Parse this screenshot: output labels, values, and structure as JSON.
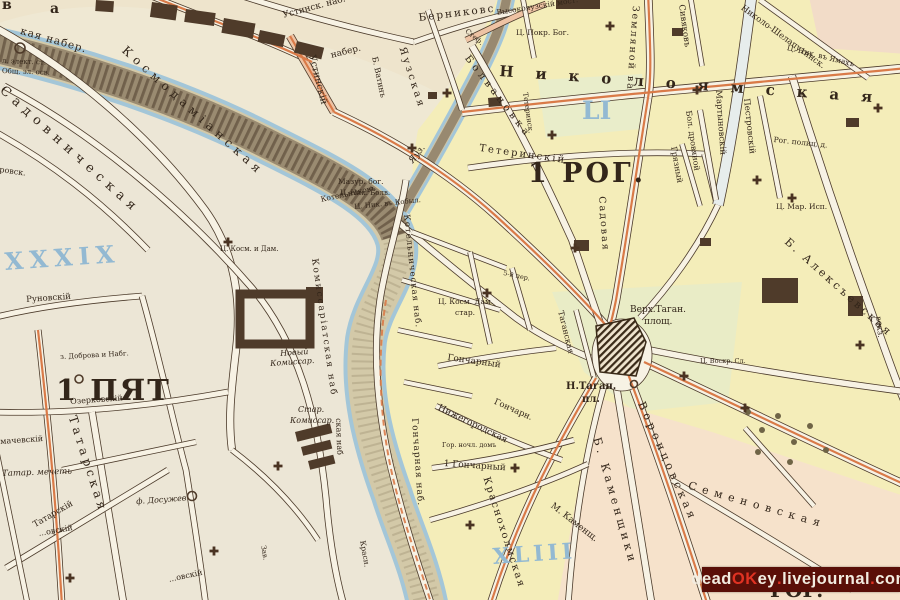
{
  "map": {
    "type": "historic-city-plan",
    "district_labels": [
      "1 ПЯТ",
      "1 РОГ.",
      "РОГ."
    ],
    "district_numerals": [
      "XXXIX",
      "LI",
      "XLIII"
    ],
    "river_labels": [
      "Яуз.",
      "Космодаміанская",
      "кая набер.",
      "Котельническая наб.",
      "Комиссаріатская наб",
      "Гончарная наб.",
      "Устинск. наб."
    ]
  },
  "palette": {
    "paper": "#efe8d3",
    "block_yellow": "#f4edb9",
    "block_cream": "#ece6d6",
    "block_pink": "#f6e2cb",
    "block_green": "#e9ecc6",
    "river_fill": "#d3c9a8",
    "river_edge": "#a3c6d8",
    "road_fill": "#f7f2e4",
    "road_casing": "#4b3a2a",
    "tram_line": "#d97a48",
    "numeral_blue": "#93b9d2",
    "ink": "#33261a",
    "building": "#4f3b2a",
    "watermark_bg": "#5a0f08"
  },
  "symbols": {
    "church_cross_icon": "greek-cross",
    "churches": [
      [
        228,
        242
      ],
      [
        412,
        148
      ],
      [
        447,
        93
      ],
      [
        575,
        248
      ],
      [
        610,
        26
      ],
      [
        697,
        90
      ],
      [
        757,
        180
      ],
      [
        684,
        376
      ],
      [
        278,
        466
      ],
      [
        214,
        551
      ],
      [
        552,
        135
      ],
      [
        487,
        293
      ],
      [
        745,
        408
      ],
      [
        792,
        198
      ],
      [
        515,
        468
      ],
      [
        470,
        525
      ],
      [
        860,
        345
      ],
      [
        878,
        108
      ],
      [
        70,
        578
      ]
    ]
  },
  "labels": [
    {
      "text": "в",
      "x": 2,
      "y": -2,
      "size": 14,
      "w": 600
    },
    {
      "text": "а",
      "x": 50,
      "y": 2,
      "size": 14,
      "w": 600
    },
    {
      "text": "кая набер.",
      "x": 22,
      "y": 26,
      "rot": 16,
      "size": 10.5,
      "sp": 1
    },
    {
      "text": "л. элект. ст.",
      "x": 2,
      "y": 58,
      "rot": 2,
      "size": 7
    },
    {
      "text": "Общ. эл. осв.",
      "x": 2,
      "y": 68,
      "rot": 2,
      "size": 7
    },
    {
      "text": "Садовническая",
      "x": 6,
      "y": 84,
      "rot": 42,
      "size": 13,
      "sp": 6
    },
    {
      "text": "Космодаміанская",
      "x": 128,
      "y": 44,
      "rot": 42,
      "size": 12,
      "sp": 5
    },
    {
      "text": "Устинск. наб.",
      "x": 282,
      "y": 12,
      "rot": -15,
      "size": 9
    },
    {
      "text": "набер.",
      "x": 330,
      "y": 52,
      "rot": -14,
      "size": 9
    },
    {
      "text": "Устинскій",
      "x": 316,
      "y": 54,
      "rot": 76,
      "size": 9.5
    },
    {
      "text": "Берниковс",
      "x": 418,
      "y": 13,
      "rot": -7,
      "size": 10.5,
      "sp": 2
    },
    {
      "text": "Высокояузскій мост.",
      "x": 496,
      "y": 9,
      "rot": -9,
      "size": 7.5
    },
    {
      "text": "Ц. Покр. Бог.",
      "x": 516,
      "y": 29,
      "size": 7.5
    },
    {
      "text": "Стеф.",
      "x": 468,
      "y": 28,
      "rot": 40,
      "size": 7
    },
    {
      "text": "Николоямская",
      "x": 500,
      "y": 64,
      "rot": 4,
      "size": 15,
      "sp": 22,
      "w": 600
    },
    {
      "text": "Земляной ва",
      "x": 640,
      "y": 6,
      "rot": 94,
      "size": 9.5,
      "sp": 2
    },
    {
      "text": "Садовая",
      "x": 606,
      "y": 196,
      "rot": 86,
      "size": 9.5,
      "sp": 2
    },
    {
      "text": "Сивяковъ",
      "x": 685,
      "y": 4,
      "rot": 82,
      "size": 8.5
    },
    {
      "text": "Николо-Шелапутинск.",
      "x": 744,
      "y": 4,
      "rot": 36,
      "size": 8.5
    },
    {
      "text": "Ц. Ник. въ Ямахъ",
      "x": 788,
      "y": 44,
      "rot": 14,
      "size": 7.5
    },
    {
      "text": "Мартыновскій",
      "x": 722,
      "y": 90,
      "rot": 86,
      "size": 8.5
    },
    {
      "text": "Бол. дровяной",
      "x": 692,
      "y": 110,
      "rot": 82,
      "size": 8
    },
    {
      "text": "Грязный",
      "x": 677,
      "y": 146,
      "rot": 80,
      "size": 8
    },
    {
      "text": "Пестровскій",
      "x": 750,
      "y": 98,
      "rot": 84,
      "size": 8.5
    },
    {
      "text": "Рог. полиц. д.",
      "x": 774,
      "y": 136,
      "rot": 6,
      "size": 7.5
    },
    {
      "text": "Ц. Мар. Исп.",
      "x": 776,
      "y": 203,
      "size": 7.5
    },
    {
      "text": "Б. Алексъевская",
      "x": 790,
      "y": 236,
      "rot": 42,
      "size": 11,
      "sp": 3
    },
    {
      "text": "вокз.",
      "x": 882,
      "y": 316,
      "rot": 84,
      "size": 8
    },
    {
      "text": "1 РОГ.",
      "x": 528,
      "y": 160,
      "size": 27,
      "w": 700,
      "sp": 3
    },
    {
      "text": "LI",
      "x": 582,
      "y": 98,
      "size": 25,
      "w": 600,
      "color": "#93b9d2"
    },
    {
      "text": "Тетеринскій",
      "x": 480,
      "y": 144,
      "rot": 8,
      "size": 10,
      "sp": 2
    },
    {
      "text": "Тетеринск.",
      "x": 528,
      "y": 92,
      "rot": 82,
      "size": 7
    },
    {
      "text": "Мазур. бог.",
      "x": 338,
      "y": 178,
      "size": 7.5
    },
    {
      "text": "Ц. Ник. Болв.",
      "x": 340,
      "y": 190,
      "size": 7
    },
    {
      "text": "Б. Ватинъ",
      "x": 378,
      "y": 56,
      "rot": 78,
      "size": 8
    },
    {
      "text": "Яузская",
      "x": 406,
      "y": 46,
      "rot": 72,
      "size": 10,
      "sp": 3
    },
    {
      "text": "Болвановка",
      "x": 470,
      "y": 54,
      "rot": 52,
      "size": 10,
      "sp": 4
    },
    {
      "text": "Котельниковъ",
      "x": 320,
      "y": 196,
      "rot": -12,
      "size": 7.5
    },
    {
      "text": "Яуз.",
      "x": 408,
      "y": 160,
      "rot": -52,
      "size": 9,
      "italic": true
    },
    {
      "text": "Ц. Ник. въ Кобыл.",
      "x": 354,
      "y": 204,
      "rot": -6,
      "size": 7
    },
    {
      "text": "5-й пер.",
      "x": 504,
      "y": 270,
      "rot": 12,
      "size": 6.5
    },
    {
      "text": "Ц. Косм. Дам.",
      "x": 438,
      "y": 298,
      "size": 7.5
    },
    {
      "text": "стар.",
      "x": 455,
      "y": 309,
      "size": 7.5
    },
    {
      "text": "Котельническая наб.",
      "x": 410,
      "y": 214,
      "rot": 84,
      "size": 8.5,
      "sp": 1
    },
    {
      "text": "Комиссаріатская наб",
      "x": 318,
      "y": 258,
      "rot": 82,
      "size": 9,
      "sp": 2
    },
    {
      "text": "Гончарная наб.",
      "x": 418,
      "y": 418,
      "rot": 86,
      "size": 9,
      "sp": 1
    },
    {
      "text": "ская наб",
      "x": 342,
      "y": 418,
      "rot": 88,
      "size": 8
    },
    {
      "text": "Красн.",
      "x": 366,
      "y": 540,
      "rot": 80,
      "size": 7.5
    },
    {
      "text": "Краснохолмская",
      "x": 490,
      "y": 476,
      "rot": 72,
      "size": 10,
      "sp": 2
    },
    {
      "text": "Гончарный",
      "x": 448,
      "y": 354,
      "rot": 8,
      "size": 9
    },
    {
      "text": "Гончарн.",
      "x": 496,
      "y": 398,
      "rot": 24,
      "size": 8.5
    },
    {
      "text": "Нижегородская",
      "x": 440,
      "y": 404,
      "rot": 26,
      "size": 9
    },
    {
      "text": "Гор. ночл. домъ",
      "x": 442,
      "y": 442,
      "size": 6.5
    },
    {
      "text": "1 Гончарный",
      "x": 444,
      "y": 460,
      "rot": 4,
      "size": 9
    },
    {
      "text": "Н.Таган.",
      "x": 566,
      "y": 382,
      "size": 10,
      "w": 600
    },
    {
      "text": "пл.",
      "x": 582,
      "y": 395,
      "size": 10,
      "w": 600
    },
    {
      "text": "Верх.Таган.",
      "x": 630,
      "y": 306,
      "size": 9
    },
    {
      "text": "площ.",
      "x": 644,
      "y": 318,
      "size": 9
    },
    {
      "text": "Таганская",
      "x": 564,
      "y": 310,
      "rot": 76,
      "size": 8
    },
    {
      "text": "Ц. Воскр. Сл.",
      "x": 700,
      "y": 358,
      "size": 6.5
    },
    {
      "text": "М. Каменщ.",
      "x": 554,
      "y": 502,
      "rot": 38,
      "size": 9
    },
    {
      "text": "Б. Каменщики",
      "x": 602,
      "y": 436,
      "rot": 74,
      "size": 11,
      "sp": 4
    },
    {
      "text": "Воронцовская",
      "x": 646,
      "y": 400,
      "rot": 66,
      "size": 11,
      "sp": 4
    },
    {
      "text": "Семеновская",
      "x": 690,
      "y": 480,
      "rot": 16,
      "size": 11,
      "sp": 6
    },
    {
      "text": "РОГ.",
      "x": 770,
      "y": 580,
      "size": 20,
      "w": 700
    },
    {
      "text": "1 ПЯТ",
      "x": 56,
      "y": 376,
      "size": 29,
      "w": 700,
      "sp": 2
    },
    {
      "text": "XXXIX",
      "x": 4,
      "y": 250,
      "rot": -4,
      "size": 24,
      "w": 600,
      "color": "#93b9d2",
      "sp": 6
    },
    {
      "text": "XLIII",
      "x": 492,
      "y": 546,
      "rot": -4,
      "size": 22,
      "w": 600,
      "color": "#93b9d2",
      "sp": 4
    },
    {
      "text": "Руновскій",
      "x": 26,
      "y": 296,
      "rot": -4,
      "size": 8.5
    },
    {
      "text": "з. Доброва и Набг.",
      "x": 60,
      "y": 354,
      "rot": -3,
      "size": 7
    },
    {
      "text": "Ц. Косм. и Дам.",
      "x": 220,
      "y": 246,
      "size": 7
    },
    {
      "text": "Новый",
      "x": 280,
      "y": 350,
      "rot": -4,
      "size": 8,
      "italic": true
    },
    {
      "text": "Комиссар.",
      "x": 270,
      "y": 360,
      "rot": -4,
      "size": 8,
      "italic": true
    },
    {
      "text": "Стар.",
      "x": 298,
      "y": 406,
      "size": 8,
      "italic": true
    },
    {
      "text": "Комиссар.",
      "x": 290,
      "y": 417,
      "size": 8,
      "italic": true
    },
    {
      "text": "Татар. мечеть",
      "x": 2,
      "y": 470,
      "rot": -2,
      "size": 8.5,
      "italic": true
    },
    {
      "text": "ф. Досужев",
      "x": 136,
      "y": 498,
      "rot": -4,
      "size": 8,
      "italic": true
    },
    {
      "text": "Татарскій",
      "x": 32,
      "y": 522,
      "rot": -30,
      "size": 8.5
    },
    {
      "text": "Татарская",
      "x": 78,
      "y": 414,
      "rot": 72,
      "size": 12,
      "sp": 4
    },
    {
      "text": "Озерковскій",
      "x": 70,
      "y": 398,
      "rot": -4,
      "size": 8
    },
    {
      "text": "мачевскій",
      "x": 0,
      "y": 438,
      "rot": -4,
      "size": 8
    },
    {
      "text": "ровск.",
      "x": 0,
      "y": 166,
      "rot": 8,
      "size": 8
    },
    {
      "text": "...овскій",
      "x": 38,
      "y": 530,
      "rot": -10,
      "size": 8
    },
    {
      "text": "...овскій",
      "x": 168,
      "y": 576,
      "rot": -12,
      "size": 8
    },
    {
      "text": "Зав.",
      "x": 266,
      "y": 545,
      "rot": 80,
      "size": 7
    }
  ],
  "watermark": {
    "bg": "#5a0f08",
    "segments": [
      {
        "t": "dead",
        "c": "#f2ece0"
      },
      {
        "t": "OK",
        "c": "#e03222"
      },
      {
        "t": "ey",
        "c": "#f2ece0"
      },
      {
        "t": ".",
        "c": "#e03222"
      },
      {
        "t": "livejournal",
        "c": "#f2ece0"
      },
      {
        "t": ".",
        "c": "#e03222"
      },
      {
        "t": "com",
        "c": "#f2ece0"
      }
    ]
  }
}
